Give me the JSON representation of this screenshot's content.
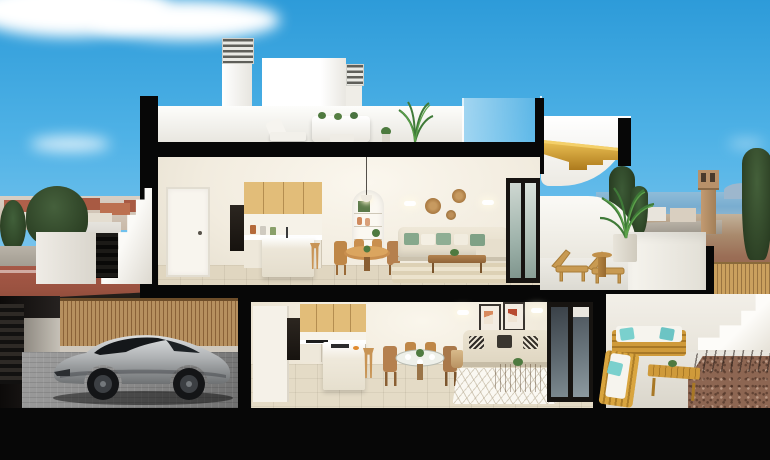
{
  "scene": {
    "title": "3D cutaway cross-section rendering of a two-storey coastal apartment house under a sunny blue sky",
    "background": "Seaside town with terracotta roofs and trees on the left, sea horizon, watchtower, cypress trees and brown fields on the right, white clouds top left",
    "rooms": {
      "rooftop_terrace": "Roof terrace with white outdoor lounge set, potted palm, louvered chimneys and white roof boxes",
      "upper_floor": "Open-plan kitchen with timber upper cabinets and white island, round timber dining table with four chairs, arched shelving niche, cream sofa with green cushions, round wicker wall plates, striped rug, dark-framed sliding glass door",
      "upper_terrace": "Terrace with two timber sun loungers, round timber side table, potted palm and curved white parapet overlooking the sea",
      "ground_floor": "Kitchen with timber upper cabinets, white peninsula island and stool, round glass dining table with timber chairs, cream two-seat sofa with patterned cushions, wicker coffee table, two framed artworks, diamond-pattern rug, sliding glass doors",
      "garage": "Silver sports coupe parked on grey pavers in front of a vertical timber slat fence, dark slatted gate at left",
      "patio": "Timber outdoor sofas with white cushions and teal pillows, timber coffee table, gravel bed, white exterior stair at right"
    },
    "structure": [
      "black cut walls and floor slabs of the section",
      "white exterior staircase at left with dark slatted entry",
      "golden timber staircase leading to the roof",
      "glass balustrades on the roof deck"
    ]
  },
  "palette": {
    "sky_top": "#2d9bd9",
    "sky_low": "#b9e0f5",
    "section_black": "#070707",
    "wall_white": "#f4efe6",
    "cabinet_wood": "#e2bd79",
    "stair_gold": "#d9a12e",
    "floor_beige": "#e5dcc8",
    "sea_blue": "#7fb3d4",
    "field_brown": "#9a6d55",
    "pillow_green": "#86a88c",
    "pillow_teal": "#7ad0cd",
    "car_silver": "#b9bcbe",
    "fence_wood": "#b6905f",
    "gravel_brown": "#8d6652",
    "town_terracotta": "#b0604a"
  }
}
